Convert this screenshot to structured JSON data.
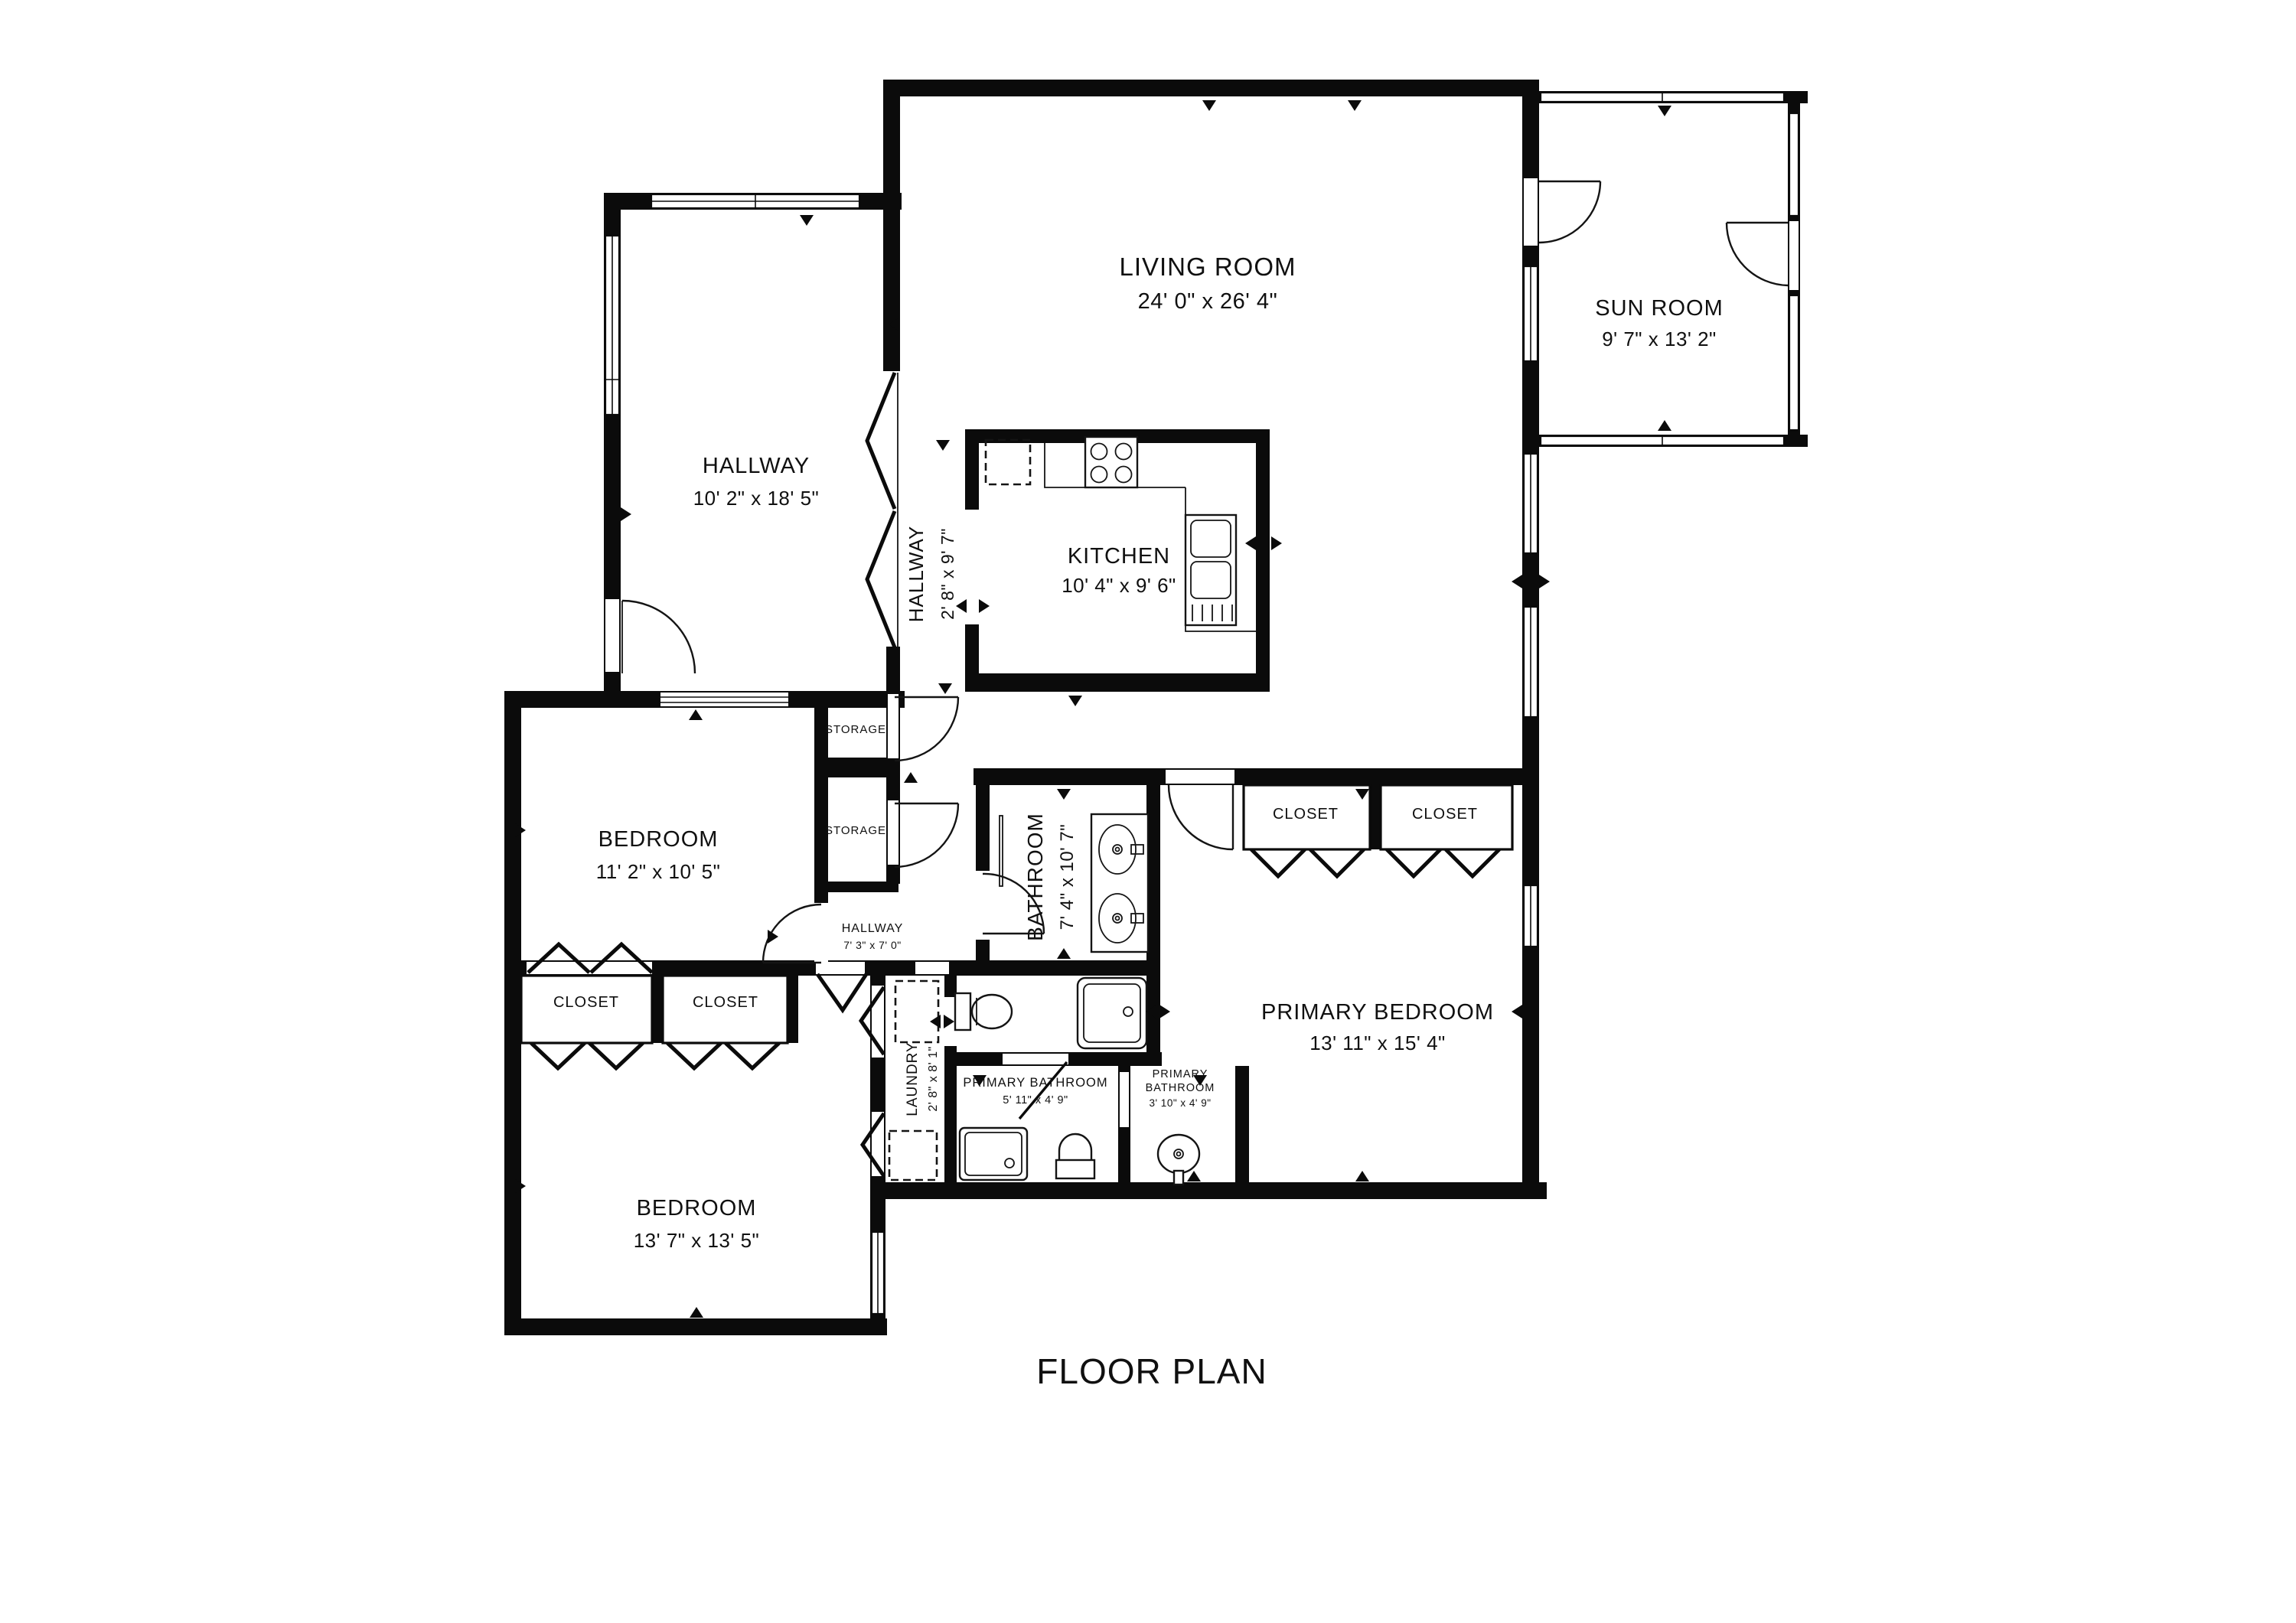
{
  "title": "FLOOR PLAN",
  "colors": {
    "wall": "#0b0b0b",
    "background": "#ffffff",
    "fixture_line": "#141414"
  },
  "rooms": {
    "living_room": {
      "label": "LIVING ROOM",
      "dims": "24' 0\" x 26' 4\""
    },
    "sun_room": {
      "label": "SUN ROOM",
      "dims": "9' 7\" x 13' 2\""
    },
    "hallway_upper": {
      "label": "HALLWAY",
      "dims": "10' 2\" x 18' 5\""
    },
    "hallway_mid": {
      "label": "HALLWAY",
      "dims": "2' 8\" x 9' 7\""
    },
    "kitchen": {
      "label": "KITCHEN",
      "dims": "10' 4\" x 9' 6\""
    },
    "bedroom_left": {
      "label": "BEDROOM",
      "dims": "11' 2\" x 10' 5\""
    },
    "storage_top": {
      "label": "STORAGE"
    },
    "storage_bottom": {
      "label": "STORAGE"
    },
    "hallway_small": {
      "label": "HALLWAY",
      "dims": "7' 3\" x 7' 0\""
    },
    "bathroom": {
      "label": "BATHROOM",
      "dims": "7' 4\" x 10' 7\""
    },
    "primary_closet_left": {
      "label": "CLOSET"
    },
    "primary_closet_right": {
      "label": "CLOSET"
    },
    "primary_bedroom": {
      "label": "PRIMARY BEDROOM",
      "dims": "13' 11\" x 15' 4\""
    },
    "closet_left": {
      "label": "CLOSET"
    },
    "closet_right": {
      "label": "CLOSET"
    },
    "bedroom_bottom": {
      "label": "BEDROOM",
      "dims": "13' 7\" x 13' 5\""
    },
    "laundry": {
      "label": "LAUNDRY",
      "dims": "2' 8\" x 8' 1\""
    },
    "primary_bathroom_left": {
      "label": "PRIMARY BATHROOM",
      "dims": "5' 11\" x 4' 9\""
    },
    "primary_bathroom_right": {
      "label_lines": [
        "PRIMARY",
        "BATHROOM"
      ],
      "dims": "3' 10\" x 4' 9\""
    }
  }
}
